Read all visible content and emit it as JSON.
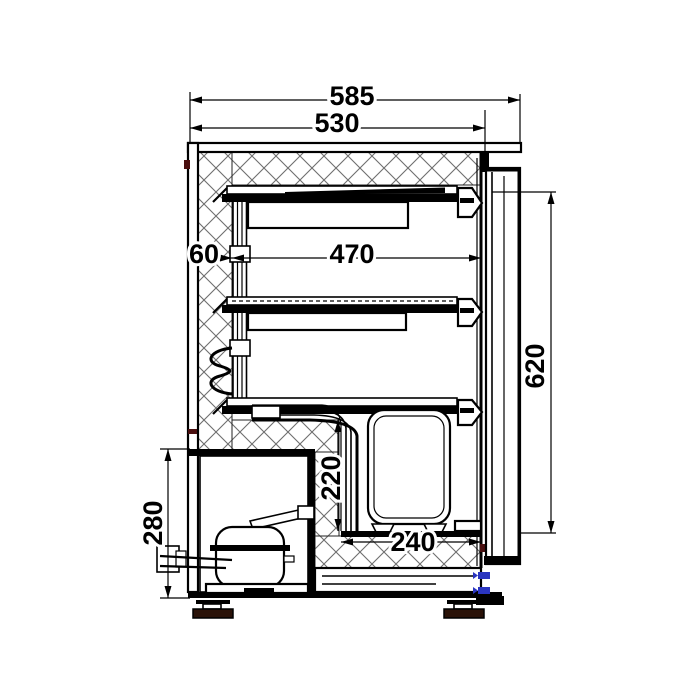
{
  "drawing": {
    "title": "refrigerator-side-section",
    "dimensions": {
      "overall_depth": "585",
      "body_depth": "530",
      "interior_depth": "470",
      "wall_thickness": "60",
      "door_height": "620",
      "step_height": "220",
      "step_depth": "240",
      "compressor_compartment_height": "280"
    },
    "colors": {
      "line": "#000000",
      "hatch": "#6e6e6e",
      "foot_pad": "#2a1208",
      "hinge_pin_blue": "#2a35c0",
      "accent_red": "#4a0f0f",
      "background": "#ffffff"
    }
  }
}
